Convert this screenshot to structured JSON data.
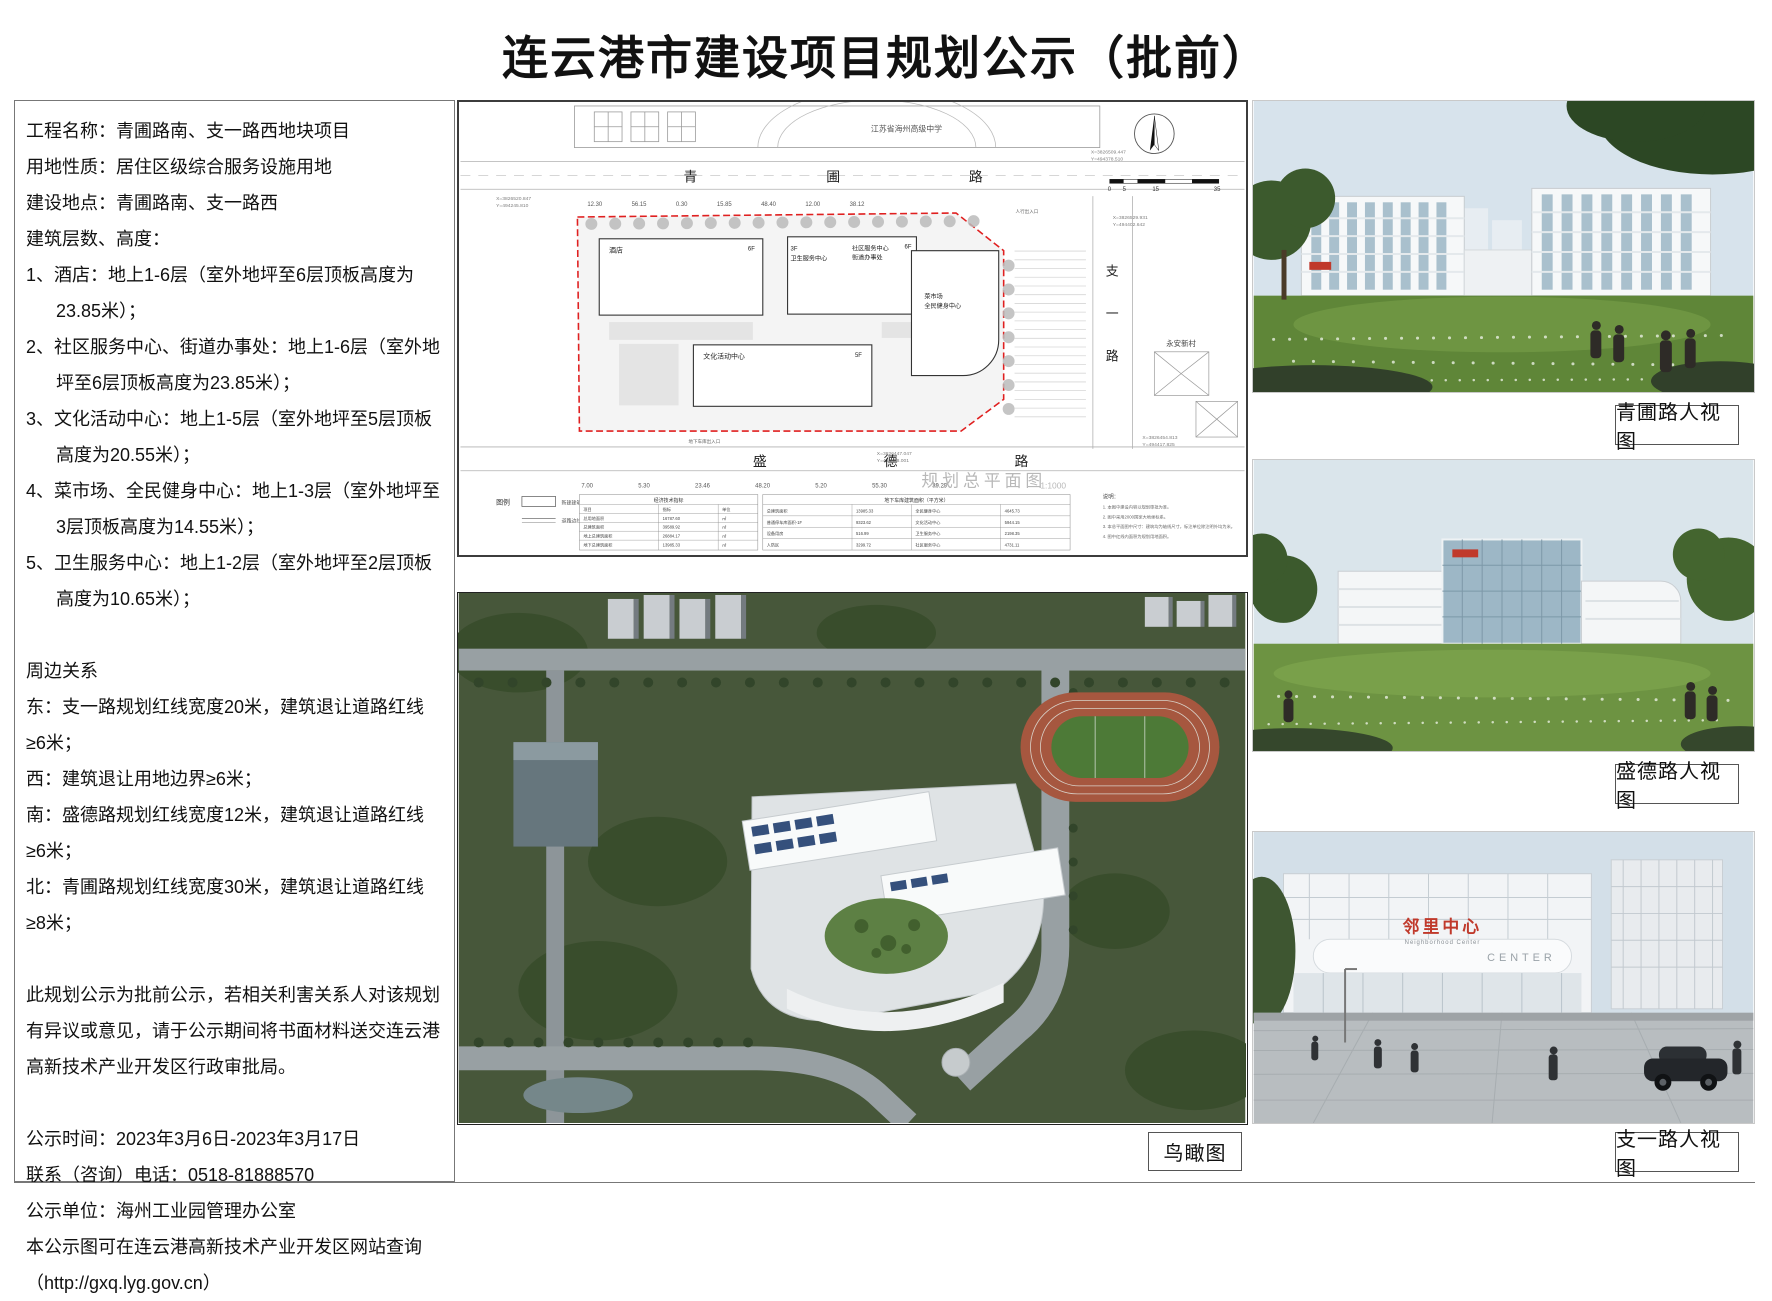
{
  "page": {
    "title": "连云港市建设项目规划公示（批前）"
  },
  "info": {
    "lines": [
      "工程名称：青圃路南、支一路西地块项目",
      "用地性质：居住区级综合服务设施用地",
      "建设地点：青圃路南、支一路西",
      "建筑层数、高度：",
      "1、酒店：地上1-6层（室外地坪至6层顶板高度为23.85米）；",
      "2、社区服务中心、街道办事处：地上1-6层（室外地坪至6层顶板高度为23.85米）；",
      "3、文化活动中心：地上1-5层（室外地坪至5层顶板高度为20.55米）；",
      "4、菜市场、全民健身中心：地上1-3层（室外地坪至3层顶板高度为14.55米）；",
      "5、卫生服务中心：地上1-2层（室外地坪至2层顶板高度为10.65米）；",
      "周边关系",
      "东：支一路规划红线宽度20米，建筑退让道路红线≥6米；",
      "西：建筑退让用地边界≥6米；",
      "南：盛德路规划红线宽度12米，建筑退让道路红线≥6米；",
      "北：青圃路规划红线宽度30米，建筑退让道路红线≥8米；",
      "此规划公示为批前公示，若相关利害关系人对该规划有异议或意见，请于公示期间将书面材料送交连云港高新技术产业开发区行政审批局。",
      "公示时间：2023年3月6日-2023年3月17日",
      "联系（咨询）电话：0518-81888570",
      "公示单位：海州工业园管理办公室",
      "本公示图可在连云港高新技术产业开发区网站查询",
      "（http://gxq.lyg.gov.cn）"
    ]
  },
  "plan": {
    "school": "江苏省海州高级中学",
    "village": "永安新村",
    "road_north": "青圃路",
    "road_south": "盛德路",
    "road_east": [
      "支",
      "一",
      "路"
    ],
    "b_hotel": "酒店",
    "b_hotel_f": "6F",
    "b_health": "卫生服务中心",
    "b_health_f": "3F",
    "b_comm": "社区服务中心",
    "b_street": "街道办事处",
    "b_comm_f": "6F",
    "b_culture": "文化活动中心",
    "b_culture_f": "5F",
    "b_market": "菜市场",
    "b_fitness": "全民健身中心",
    "entrance": "人行出入口",
    "garage_entrance": "地下车库出入口",
    "dims_top": "12.30 56.15 0.30 15.85 48.40 12.00 38.12",
    "dims_bottom": "7.00 5.30 23.46 48.20 5.20 55.30 39.29",
    "coords": [
      {
        "x": "X=3826520.847",
        "y": "Y=494245.810"
      },
      {
        "x": "X=3826509.447",
        "y": "Y=494378.510"
      },
      {
        "x": "X=3826529.931",
        "y": "Y=494402.642"
      },
      {
        "x": "X=3826454.813",
        "y": "Y=494417.825"
      },
      {
        "x": "X=3826447.047",
        "y": "Y=494358.001"
      }
    ],
    "scale_ticks": [
      "0",
      "5",
      "15",
      "35"
    ],
    "legend_label": "图例",
    "legend_item1": "新建建筑物",
    "legend_item2": "道路边线",
    "table1_title": "经济技术指标",
    "table1_headers": [
      "项目",
      "指标",
      "单位"
    ],
    "table1_rows": [
      [
        "总用地面积",
        "16787.60",
        "㎡"
      ],
      [
        "总建筑面积",
        "39589.92",
        "㎡"
      ],
      [
        "地上总建筑面积",
        "26884.17",
        "㎡"
      ],
      [
        "地下总建筑面积",
        "13985.33",
        "㎡"
      ]
    ],
    "table2_title": "地下车库建筑面积（平方米）",
    "table2_rows": [
      [
        "总建筑面积",
        "13985.33"
      ],
      [
        "普通停车库面积-1F",
        "9323.62"
      ],
      [
        "设备用房",
        "516.99"
      ],
      [
        "人防区",
        "3299.72"
      ]
    ],
    "table3_rows": [
      [
        "全民健身中心",
        "4645.73"
      ],
      [
        "文化活动中心",
        "5944.15"
      ],
      [
        "卫生服务中心",
        "2198.35"
      ],
      [
        "社区服务中心",
        "4731.11"
      ]
    ],
    "notes_title": "说明：",
    "notes": [
      "1. 本图中建设内容以规划审批为准。",
      "2. 图中采用2000国家大地坐标系。",
      "3. 本总平面图中尺寸：建筑均为轴线尺寸，标注单位除注明外均为米。",
      "4. 图中红线内面积为规划用地面积。"
    ],
    "main_title": "规划总平面图",
    "main_scale": "1:1000"
  },
  "views": {
    "qingpu_label": "青圃路人视图",
    "shengde_label": "盛德路人视图",
    "zhiyi_label": "支一路人视图",
    "aerial_label": "鸟瞰图",
    "zhiyi_sign": "邻里中心",
    "zhiyi_sign_en": "Neighborhood Center",
    "zhiyi_band_en": "CENTER"
  },
  "colors": {
    "boundary_red": "#e02020",
    "sign_red": "#c0392b",
    "lawn_green": "#5f8638",
    "sky_blue": "#d7e3ec",
    "track_red": "#a6573f",
    "field_green": "#4d7a37"
  }
}
